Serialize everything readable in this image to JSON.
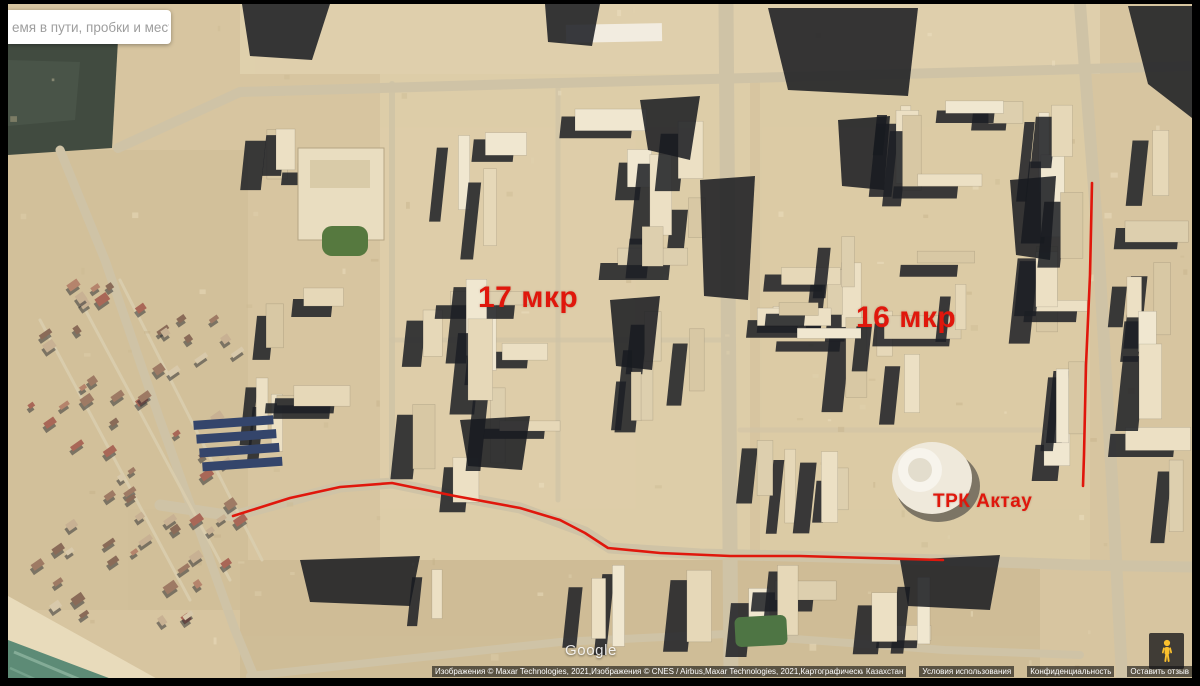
{
  "window": {
    "width": 1200,
    "height": 686,
    "app": "maps-satellite-view"
  },
  "search": {
    "placeholder": "емя в пути, пробки и места"
  },
  "map": {
    "annotation_color": "#e0170c",
    "labels": [
      {
        "id": "district-label-17-mkr",
        "text": "17 мкр",
        "x": 478,
        "y": 283,
        "size": 30
      },
      {
        "id": "district-label-16-mkr",
        "text": "16 мкр",
        "x": 856,
        "y": 303,
        "size": 30
      },
      {
        "id": "poi-label-trk-aktau",
        "text": "ТРК Актау",
        "x": 933,
        "y": 492,
        "size": 19
      }
    ],
    "routes": [
      {
        "name": "route-line-main-road",
        "points": "233,516 290,498 340,487 392,483 455,496 520,508 560,520 585,533 608,548 660,553 730,556 800,556 870,558 943,560"
      },
      {
        "name": "route-line-right-road",
        "points": "1092,183 1091,230 1090,275 1088,320 1086,365 1085,410 1084,455 1083,486"
      }
    ]
  },
  "branding": {
    "logo": "Google"
  },
  "attribution": {
    "imagery": "Изображения © Maxar Technologies, 2021,Изображения © CNES / Airbus,Maxar Technologies, 2021,Картографические данные ©, 2021",
    "links": [
      "Казахстан",
      "Условия использования",
      "Конфиденциальность",
      "Оставить отзыв"
    ]
  }
}
